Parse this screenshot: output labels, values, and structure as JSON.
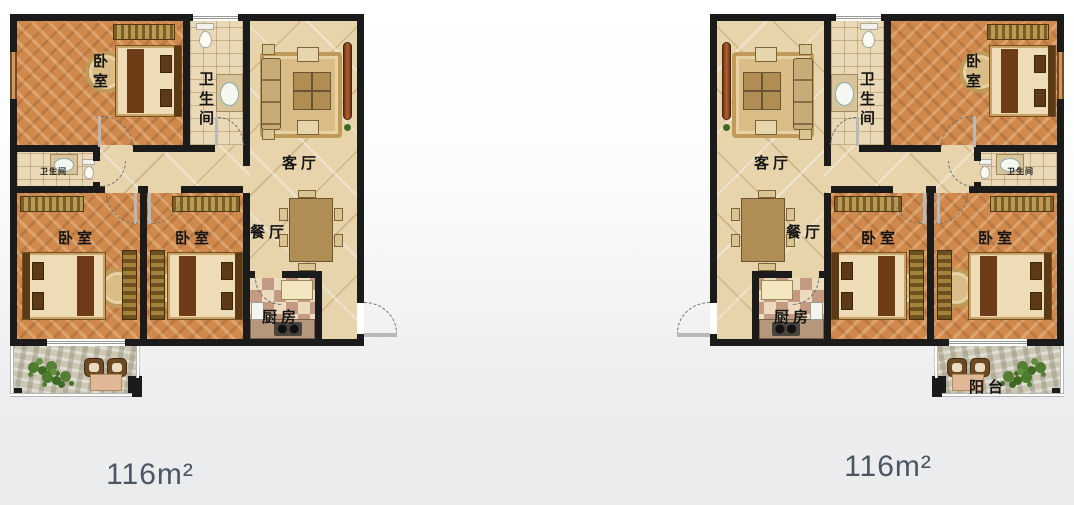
{
  "page": {
    "colors": {
      "wall": "#1b1b1b",
      "wood_floor": "#d0894d",
      "marble_floor": "#e7d4ab",
      "tile_floor": "#ead9b6",
      "stone_floor": "#ccc7b5",
      "area_text": "#4c5665"
    }
  },
  "plans": [
    {
      "name": "unit-left",
      "area_label": "116m²",
      "rooms": {
        "bedroom_top": "卧室",
        "bathroom_main": "卫生间",
        "living_room": "客厅",
        "bathroom_small": "卫生间",
        "bedroom_left": "卧室",
        "bedroom_middle": "卧室",
        "dining_room": "餐厅",
        "kitchen": "厨房",
        "balcony": ""
      }
    },
    {
      "name": "unit-right",
      "area_label": "116m²",
      "rooms": {
        "bedroom_top": "卧室",
        "bathroom_main": "卫生间",
        "living_room": "客厅",
        "bathroom_small": "卫生间",
        "bedroom_left": "卧室",
        "bedroom_middle": "卧室",
        "dining_room": "餐厅",
        "kitchen": "厨房",
        "balcony": "阳台"
      }
    }
  ]
}
